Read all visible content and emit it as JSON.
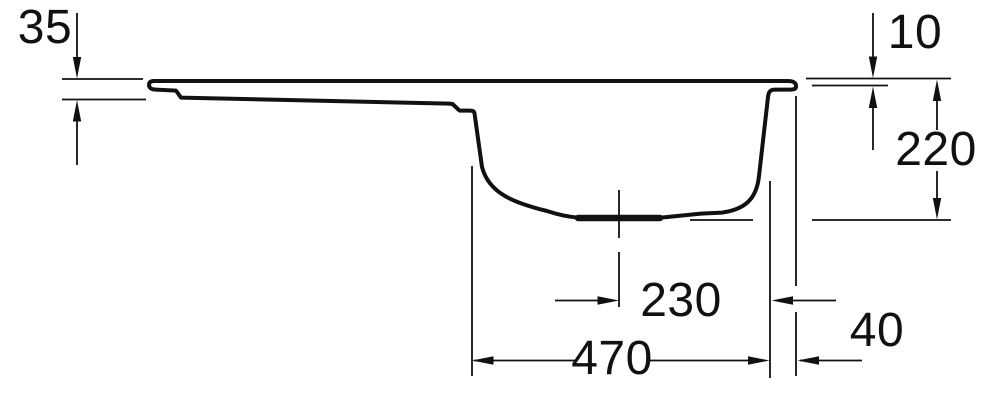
{
  "drawing": {
    "subject": "Kitchen sink with drainer - side cross-section, dimensioned technical drawing",
    "units": "mm",
    "colors": {
      "line": "#111111",
      "background": "#ffffff"
    },
    "labels": {
      "left_edge_height": "35",
      "rim_height": "10",
      "bowl_depth": "220",
      "drain_center_to_bowl_right": "230",
      "bowl_width": "470",
      "right_rim_width": "40"
    }
  }
}
